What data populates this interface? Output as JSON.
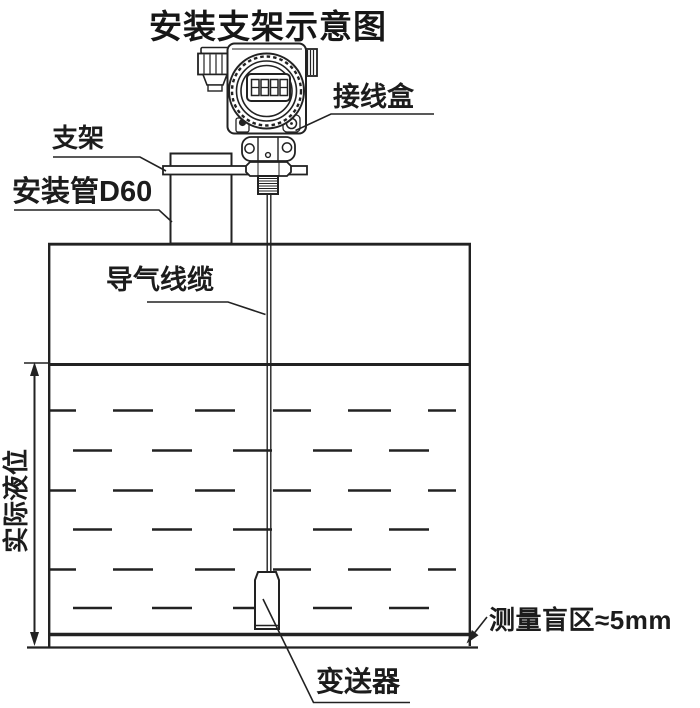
{
  "title": "安装支架示意图",
  "labels": {
    "bracket": "支架",
    "mounting_pipe": "安装管D60",
    "junction_box": "接线盒",
    "air_cable": "导气线缆",
    "actual_level": "实际液位",
    "blind_zone": "测量盲区≈5mm",
    "transmitter": "变送器"
  },
  "colors": {
    "line": "#222222",
    "background": "#ffffff"
  }
}
